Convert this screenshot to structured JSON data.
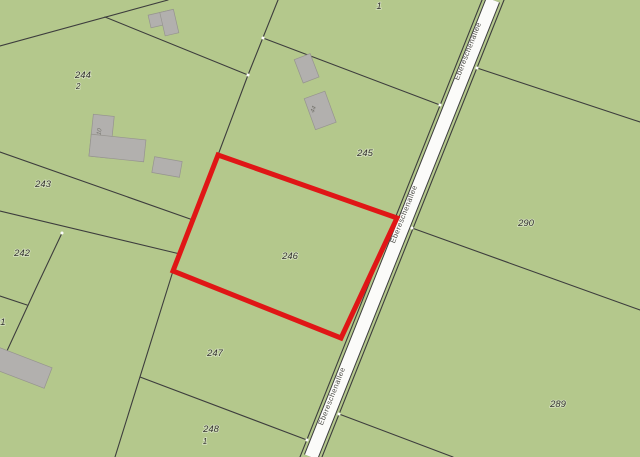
{
  "map": {
    "street": {
      "name": "Ebereschenallee"
    },
    "parcel_labels": {
      "corner_top": "1",
      "p244": {
        "num": "244",
        "den": "2"
      },
      "p243": "243",
      "p242": "242",
      "p_left_edge": "01",
      "p245": "245",
      "p246": "246",
      "p247": "247",
      "p248": {
        "num": "248",
        "den": "1"
      },
      "p290": "290",
      "p289": "289"
    },
    "building_labels": {
      "house10": "10",
      "house44": "44"
    },
    "colors": {
      "parcel_fill": "#b4c88c",
      "boundary_line": "#3d3d3d",
      "road_fill": "#fbfbf9",
      "selection_outline": "#e01616",
      "building_fill": "#b2b0ae"
    },
    "selected_parcel": "246"
  }
}
